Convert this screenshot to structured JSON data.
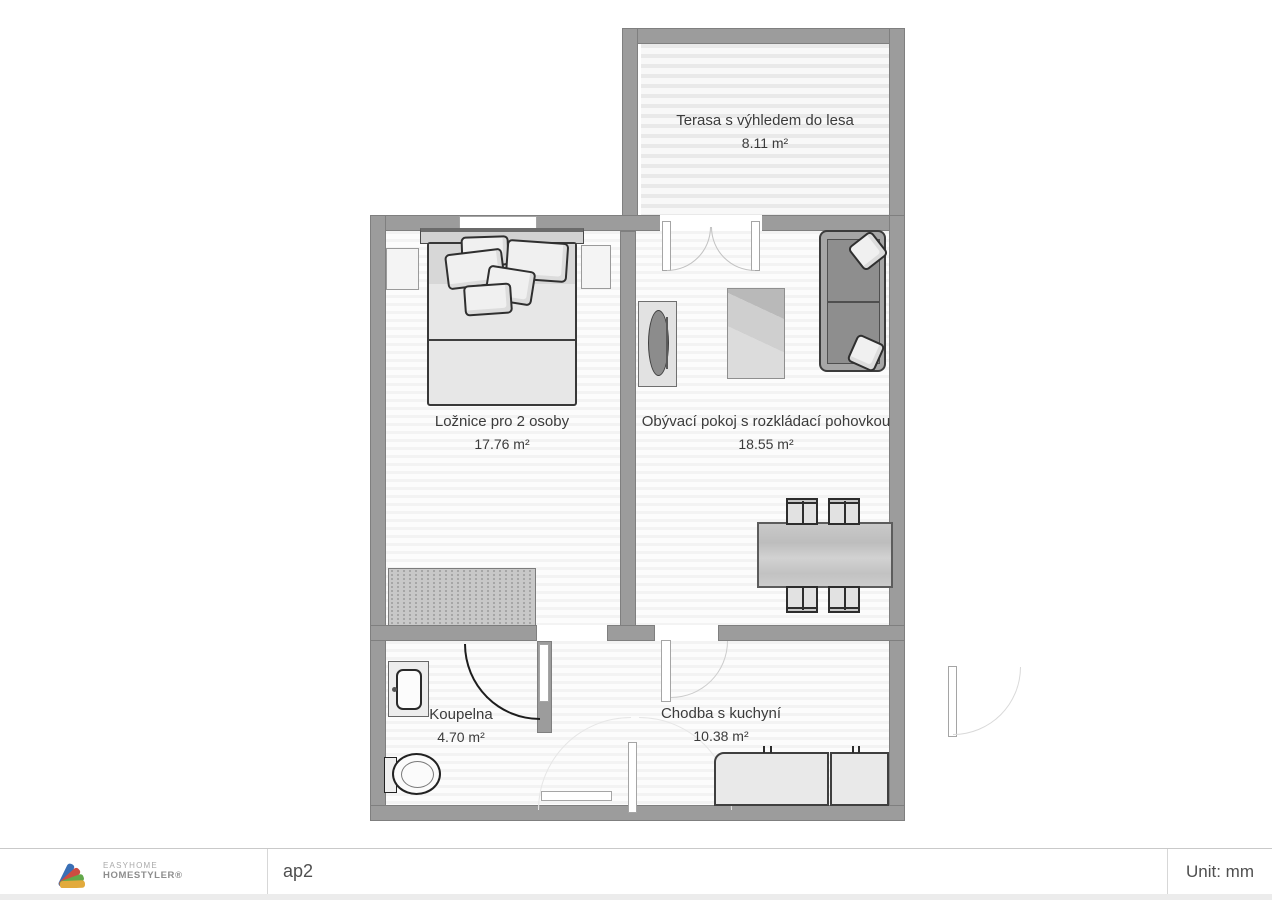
{
  "plan": {
    "rooms": [
      {
        "id": "terrace",
        "name": "Terasa s výhledem do lesa",
        "area": "8.11 m²"
      },
      {
        "id": "bedroom",
        "name": "Ložnice pro 2 osoby",
        "area": "17.76 m²"
      },
      {
        "id": "living",
        "name": "Obývací pokoj s rozkládací pohovkou",
        "area": "18.55 m²"
      },
      {
        "id": "bathroom",
        "name": "Koupelna",
        "area": "4.70 m²"
      },
      {
        "id": "hallway",
        "name": "Chodba s kuchyní",
        "area": "10.38 m²"
      }
    ],
    "furniture_symbols": [
      "double-bed",
      "nightstand",
      "dresser",
      "tv-cabinet",
      "tv",
      "rug",
      "sofa-bed",
      "dining-table",
      "dining-chair",
      "kitchen-counter",
      "sink-vanity",
      "toilet",
      "door-swing",
      "french-door",
      "window"
    ],
    "wall_color": "#9c9c9c"
  },
  "footer": {
    "logo": {
      "line1": "EASYHOME",
      "line2": "HOMESTYLER®",
      "colors": [
        "#3a6fb5",
        "#cd4c41",
        "#63a84a",
        "#e2aa3c"
      ]
    },
    "project_name": "ap2",
    "unit_label": "Unit: mm"
  }
}
